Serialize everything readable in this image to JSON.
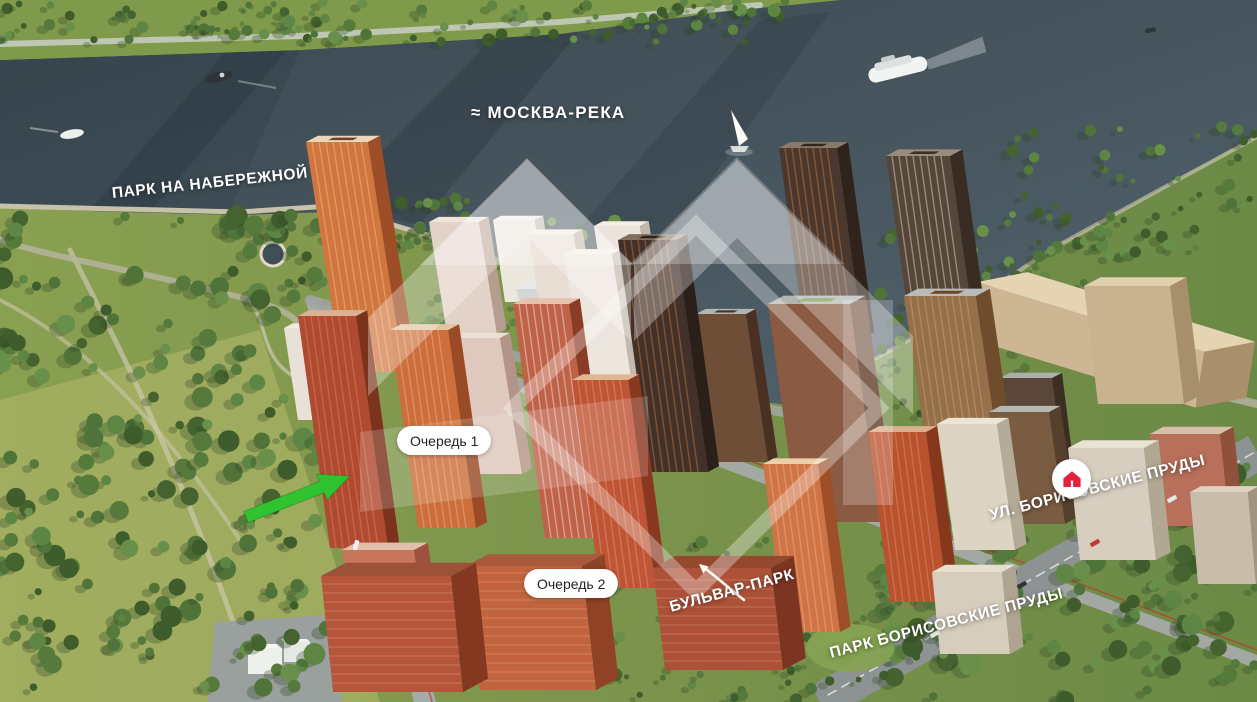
{
  "labels": {
    "river": "≈ МОСКВА-РЕКА",
    "park_embankment": "ПАРК НА НАБЕРЕЖНОЙ",
    "phase1": "Очередь 1",
    "phase2": "Очередь 2",
    "boulevard": "БУЛЬВАР-ПАРК",
    "park_borisovskie": "ПАРК БОРИСОВСКИЕ ПРУДЫ",
    "street_borisovskie": "УЛ. БОРИСОВСКИЕ ПРУДЫ"
  },
  "icons": {
    "home_marker": "home-icon",
    "pointer_arrow": "green-arrow",
    "boulevard_arrow": "white-arrow"
  },
  "colors": {
    "river": "#47565f",
    "river_dark": "#3b4952",
    "river_light": "#54656f",
    "park_green": "#7d944c",
    "meadow": "#a8b264",
    "tree_green": "#4e7038",
    "road_grey": "#a6aaa8",
    "main_road_grey": "#8d9392",
    "accent_red_line": "#c0392b",
    "marker_red": "#e3213f",
    "arrow_green": "#2fc42f",
    "watermark_white": "#ffffff",
    "label_white": "#ffffff",
    "pill_bg": "#ffffff",
    "pill_text": "#222222"
  }
}
